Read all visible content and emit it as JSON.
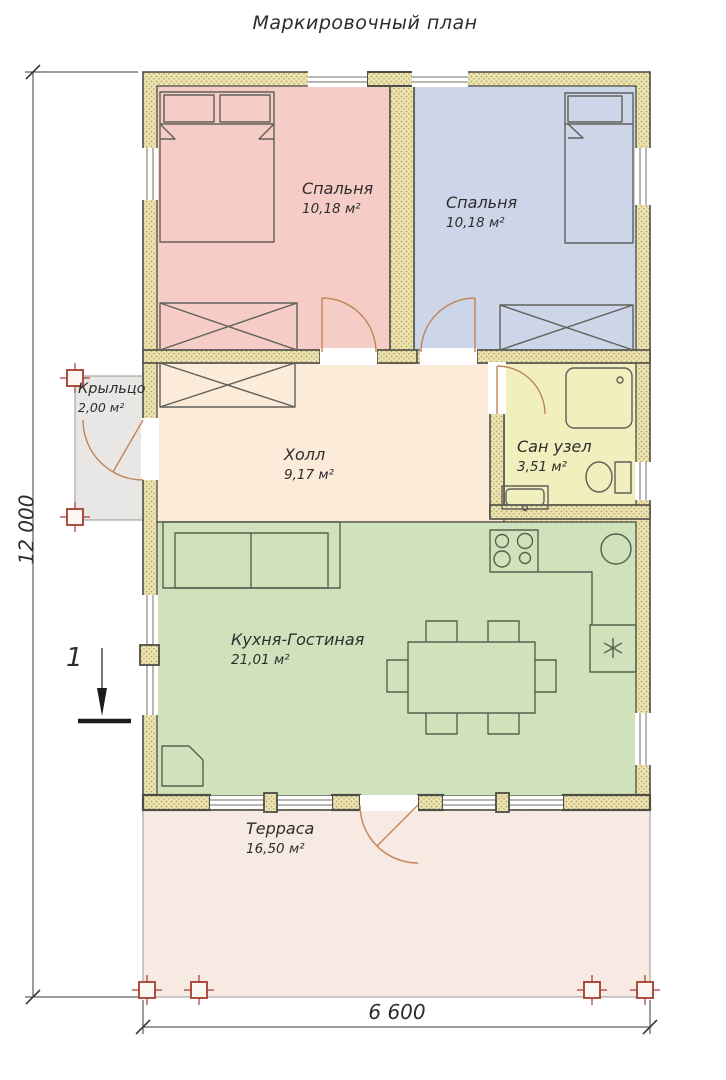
{
  "title": "Маркировочный план",
  "plan": {
    "rooms": [
      {
        "id": "bedroom-left",
        "name": "Спальня",
        "area": "10,18 м²",
        "fill": "#f6ccc6"
      },
      {
        "id": "bedroom-right",
        "name": "Спальня",
        "area": "10,18 м²",
        "fill": "#cdd5e8"
      },
      {
        "id": "hall",
        "name": "Холл",
        "area": "9,17 м²",
        "fill": "#fcebd9"
      },
      {
        "id": "bathroom",
        "name": "Сан узел",
        "area": "3,51 м²",
        "fill": "#f1efbd"
      },
      {
        "id": "kitchen-living",
        "name": "Кухня-Гостиная",
        "area": "21,01 м²",
        "fill": "#cfe2bc"
      },
      {
        "id": "porch",
        "name": "Крыльцо",
        "area": "2,00 м²",
        "fill": "#e9e7e5"
      },
      {
        "id": "terrace",
        "name": "Терраса",
        "area": "16,50 м²",
        "fill": "#f6eae3"
      }
    ],
    "dimensions": {
      "vertical": "12 000",
      "horizontal": "6 600"
    },
    "section_label": "1",
    "colors": {
      "wall_fill": "#ece3b0",
      "wall_dot": "#b5a76b",
      "wall_edge": "#4e4e47",
      "door": "#c08457",
      "column_marker": "#a63c2c",
      "dimension": "#3a3a3a",
      "furniture": "#60605a",
      "kitchen_furniture": "#55624d",
      "text": "#2d2d2d"
    }
  }
}
